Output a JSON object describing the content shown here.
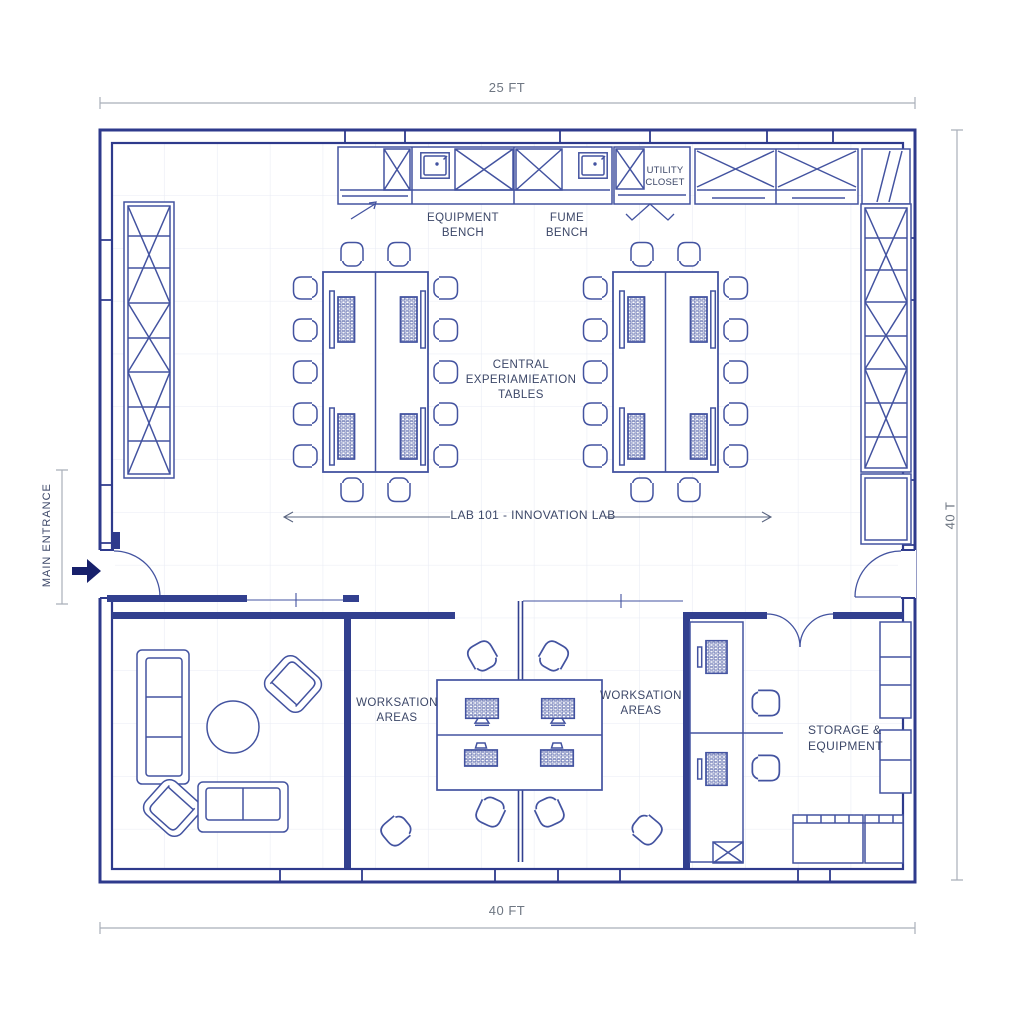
{
  "colors": {
    "wall": "#2e3a8c",
    "line": "#4353a0",
    "grid": "#e8ebf4",
    "dimension_line": "#a9afb9",
    "label_text": "#3c4768",
    "dimension_text": "#6e7682",
    "entrance_arrow": "#17206b",
    "background": "#ffffff"
  },
  "dimensions": {
    "width_top": "25 FT",
    "width_bottom": "40 FT",
    "height_right": "40 T"
  },
  "entrance": {
    "label": "MAIN ENTRANCE"
  },
  "lab": {
    "name": "LAB 101 - INNOVATION LAB",
    "equipment_bench": "EQUIPMENT\nBENCH",
    "fume_bench": "FUME\nBENCH",
    "utility_closet": "UTILITY\nCLOSET",
    "central_tables": "CENTRAL\nEXPERIAMIEATION\nTABLES"
  },
  "rooms": {
    "workstation_left": "WORKSATION\nAREAS",
    "workstation_right": "WORKSATION\nAREAS",
    "storage": "STORAGE &\nEQUIPMENT"
  }
}
